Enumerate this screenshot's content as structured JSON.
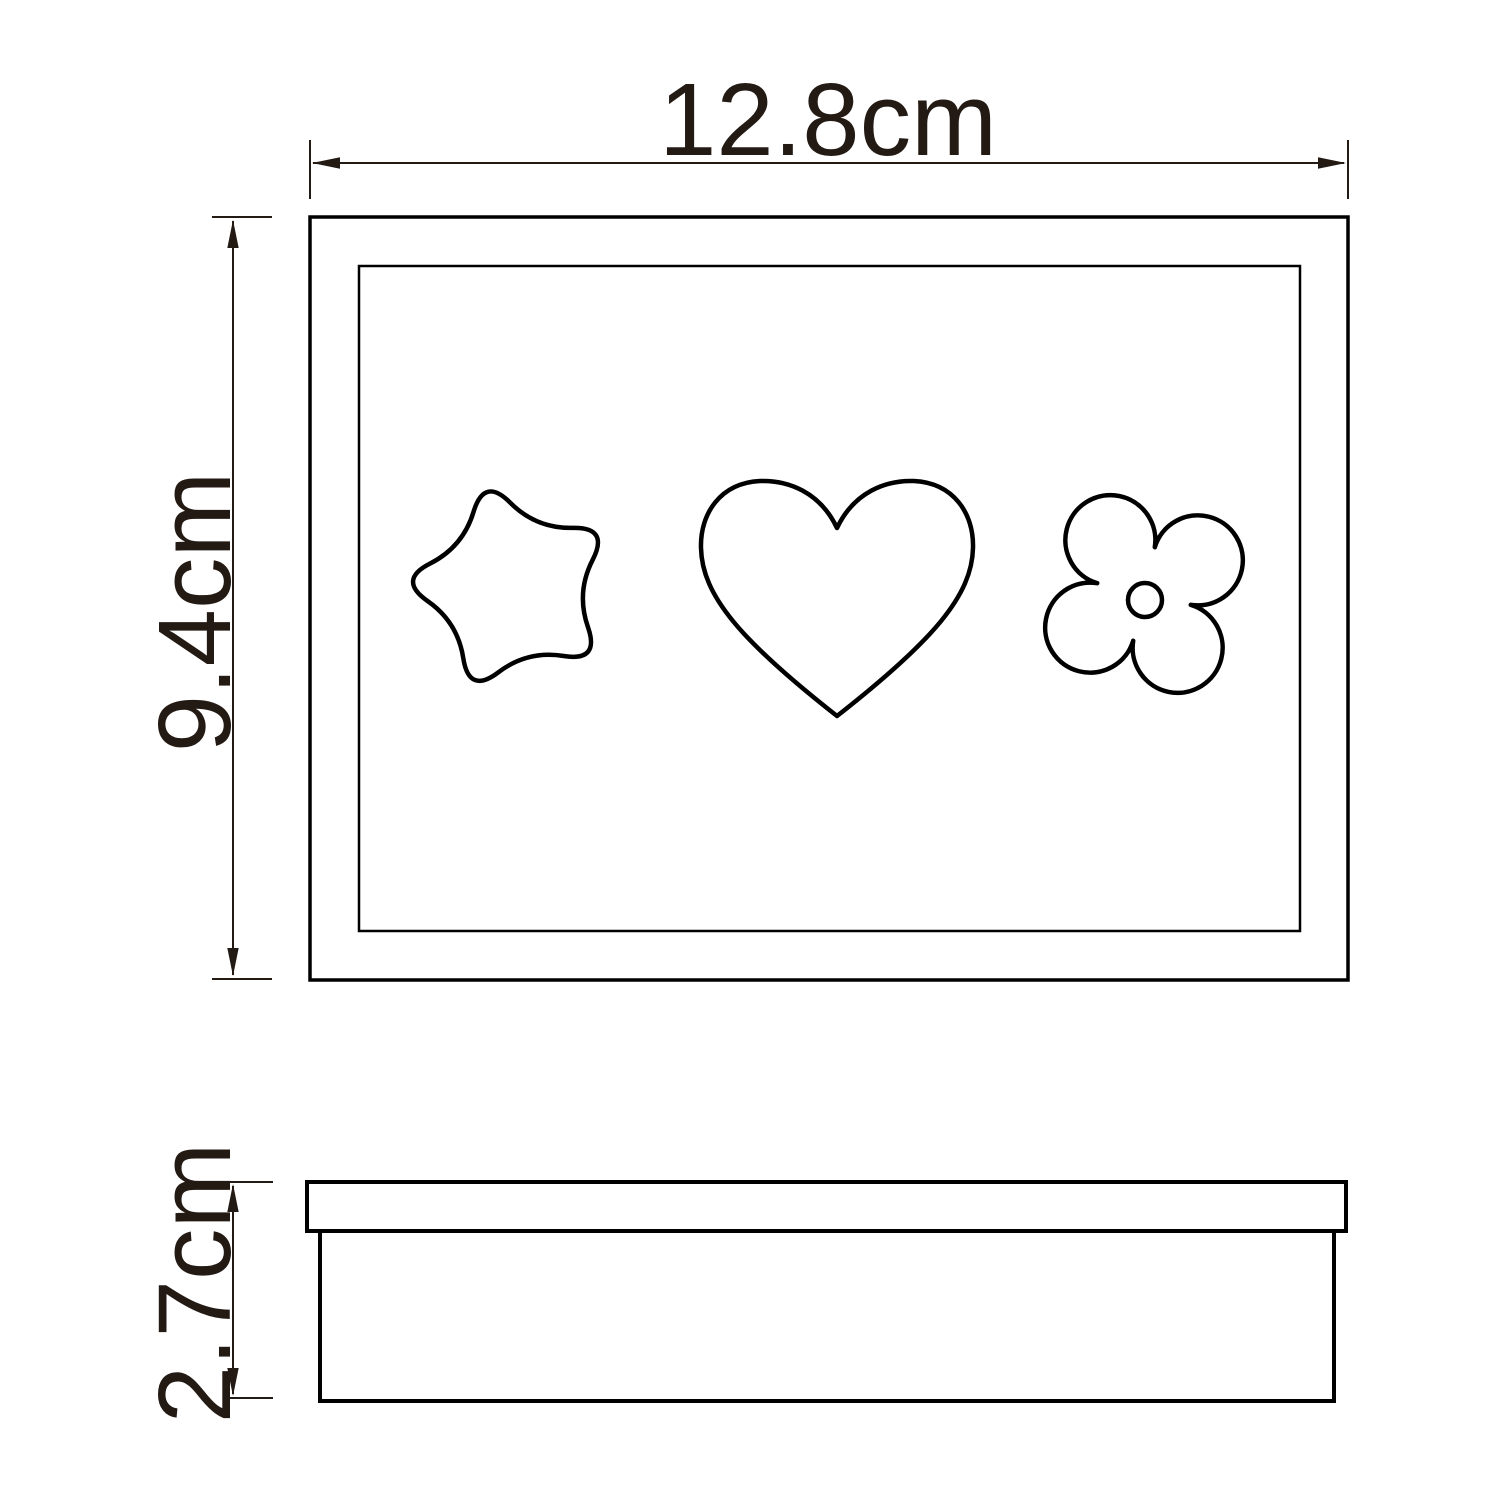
{
  "dimensions": {
    "width_label": "12.8cm",
    "height_label": "9.4cm",
    "depth_label": "2.7cm"
  },
  "views": {
    "top_view_cutouts": [
      "star",
      "heart",
      "flower"
    ],
    "side_view_parts": [
      "lid",
      "body"
    ]
  },
  "colors": {
    "outline": "#000000",
    "dimension_ink": "#241a14",
    "background": "#ffffff"
  }
}
